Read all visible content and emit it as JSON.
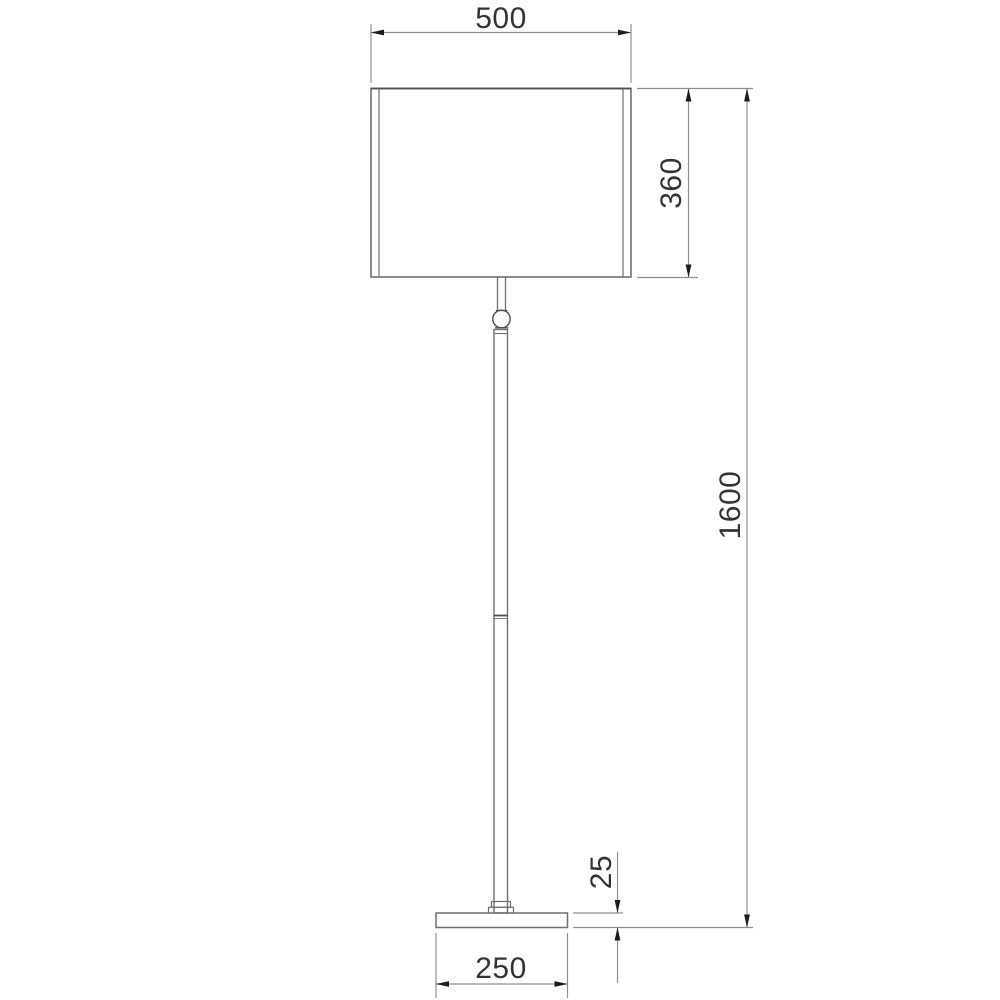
{
  "drawing": {
    "type": "technical-dimension-drawing",
    "subject": "floor-lamp front elevation",
    "colors": {
      "background": "#ffffff",
      "geometry_line": "#6f6f6f",
      "dimension_line": "#8f8f8f",
      "arrow": "#1c1c1c",
      "text": "#333333"
    },
    "dims": {
      "shade_width": {
        "label": "500",
        "value": 500,
        "orientation": "horizontal",
        "measures": "lamp shade width"
      },
      "shade_height": {
        "label": "360",
        "value": 360,
        "orientation": "vertical",
        "measures": "lamp shade height"
      },
      "total_height": {
        "label": "1600",
        "value": 1600,
        "orientation": "vertical",
        "measures": "overall lamp height"
      },
      "base_height": {
        "label": "25",
        "value": 25,
        "orientation": "vertical",
        "measures": "base plate thickness"
      },
      "base_width": {
        "label": "250",
        "value": 250,
        "orientation": "horizontal",
        "measures": "base plate width"
      }
    },
    "parts": [
      "lamp-shade",
      "stem-tube",
      "finial-connector",
      "lamp-pole",
      "pole-joint",
      "pole-foot-collar",
      "base-plate"
    ]
  }
}
